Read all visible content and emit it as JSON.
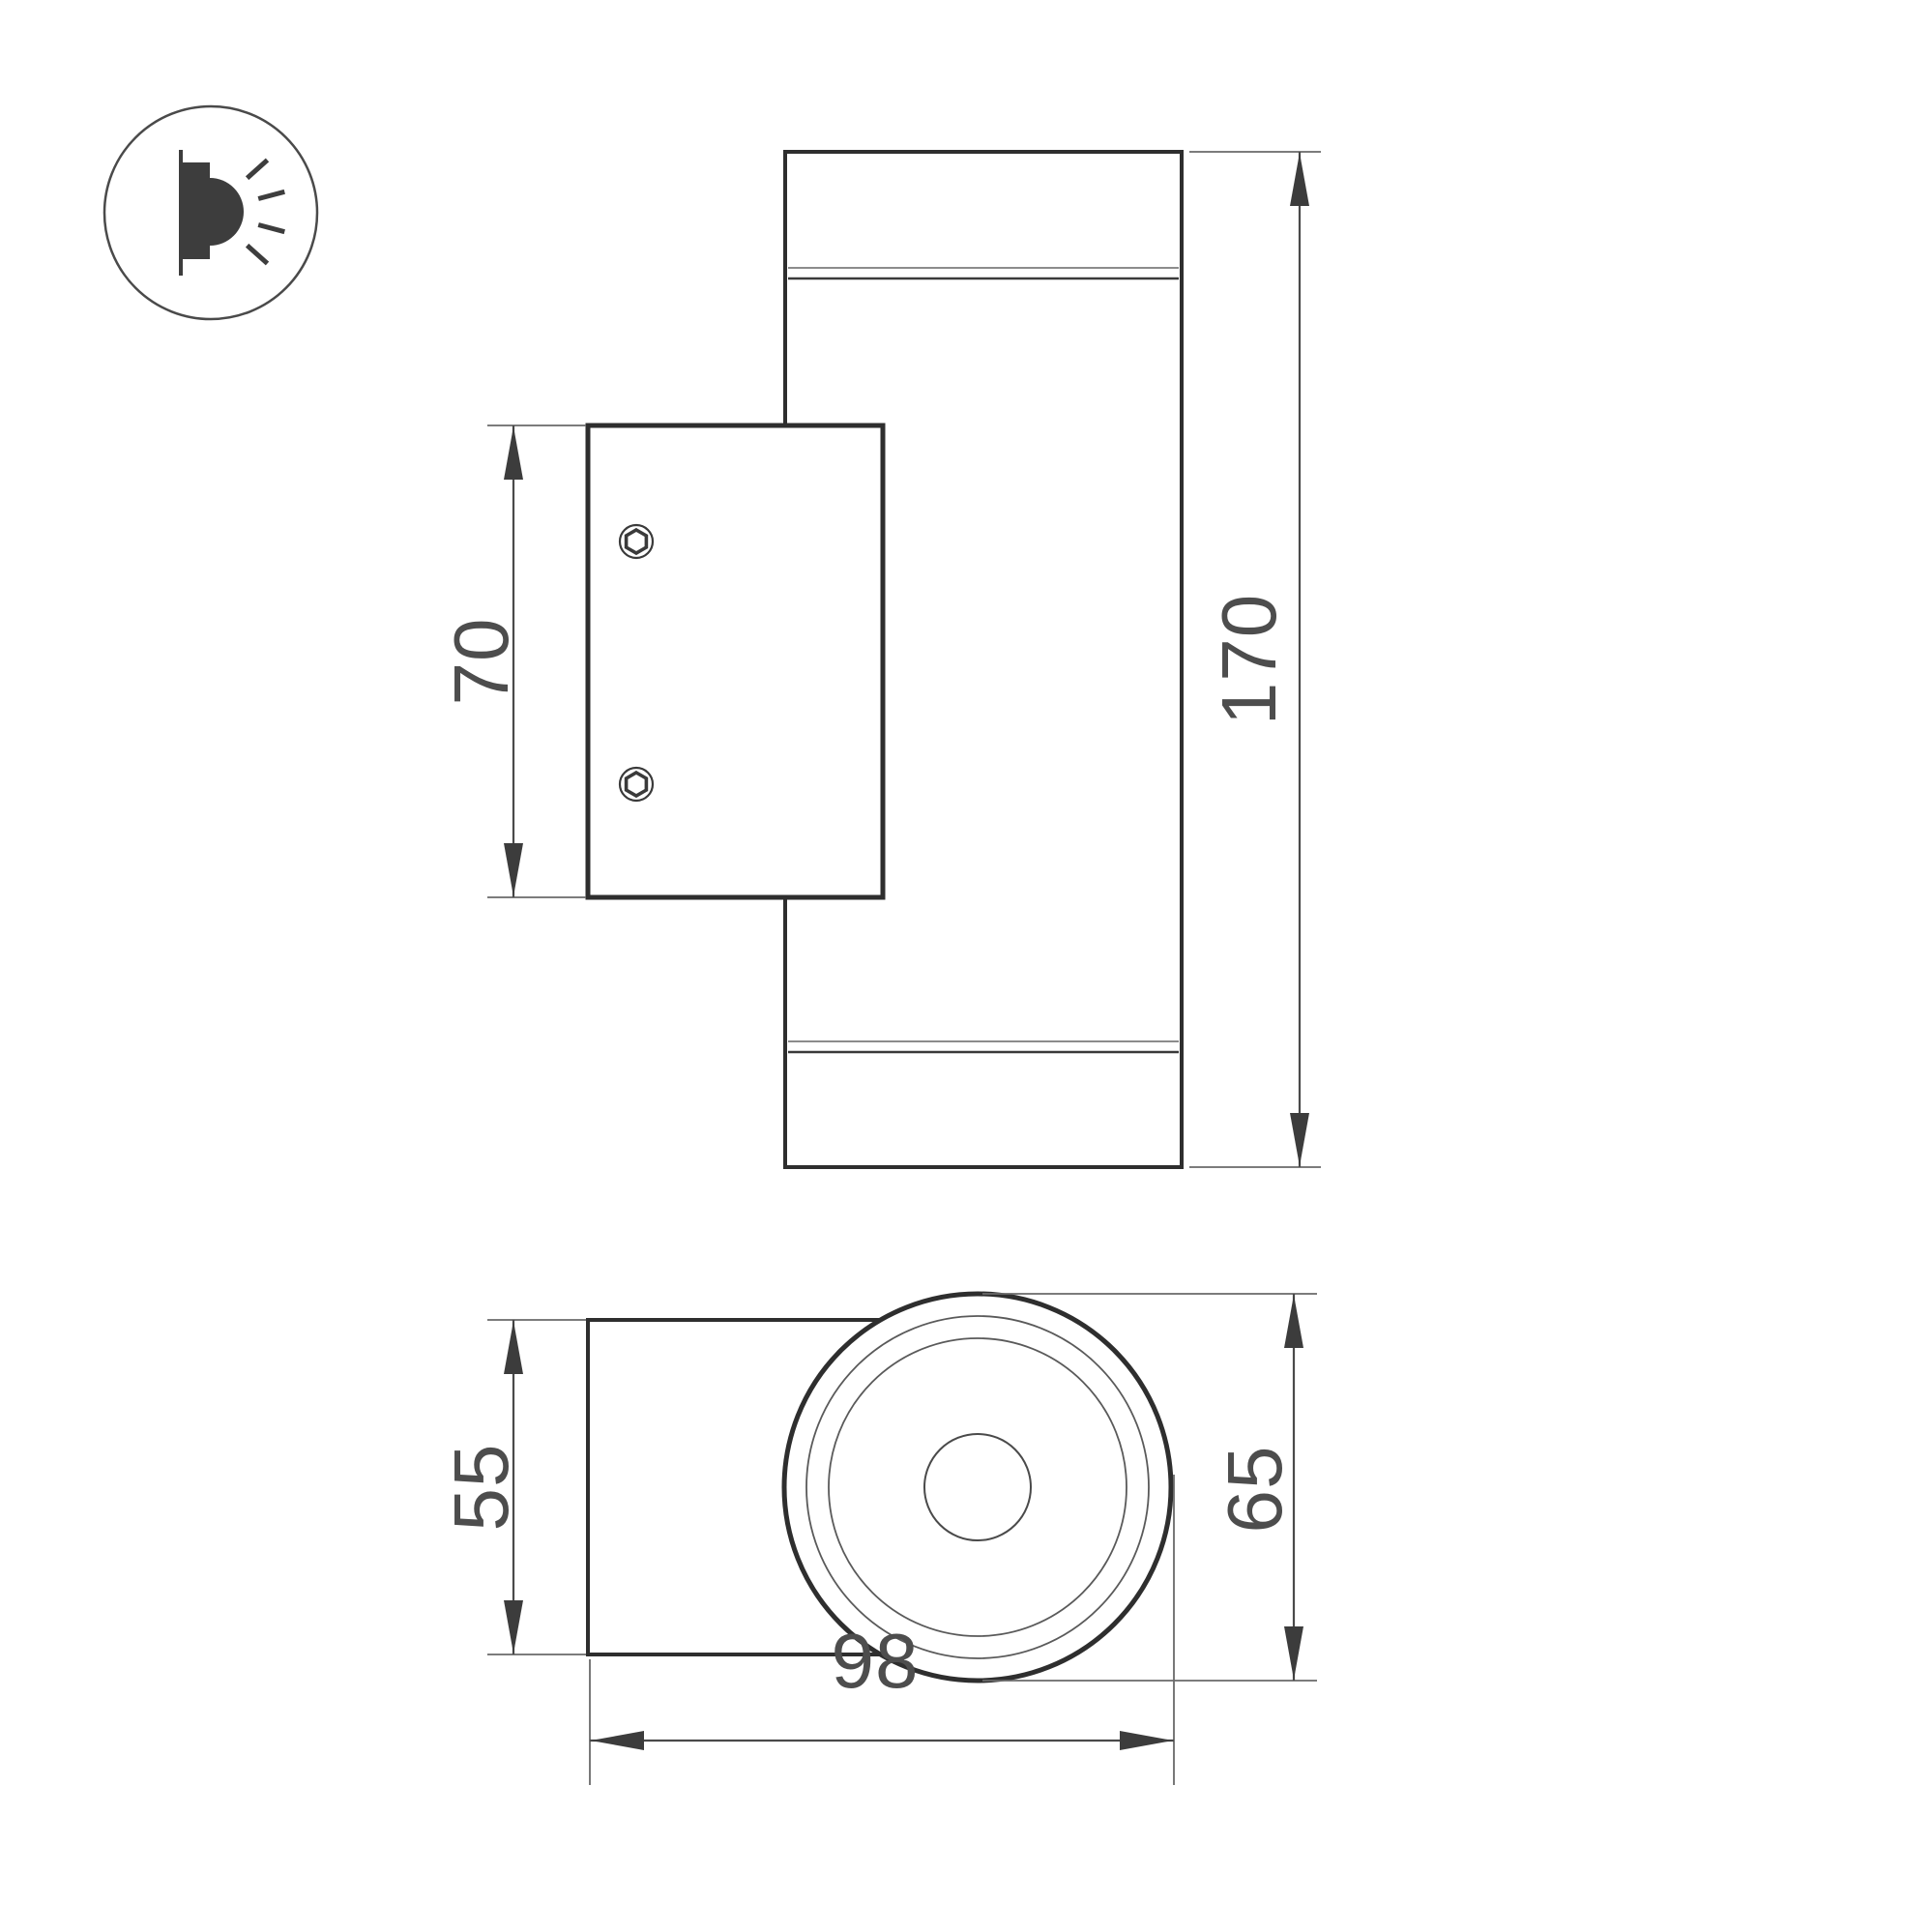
{
  "icon": {
    "name": "wall-mounted-light-icon"
  },
  "dimensions": {
    "plate_height": "70",
    "body_length": "170",
    "plate_depth": "55",
    "body_diameter": "65",
    "overall_depth": "98"
  },
  "colors": {
    "background": "#ffffff",
    "outline_strong": "#2e2e2e",
    "outline_thin": "#8c8c8c",
    "dimension_line": "#4a4a4a",
    "label_text": "#4d4d4d",
    "icon_glyph": "#3d3d3d"
  }
}
